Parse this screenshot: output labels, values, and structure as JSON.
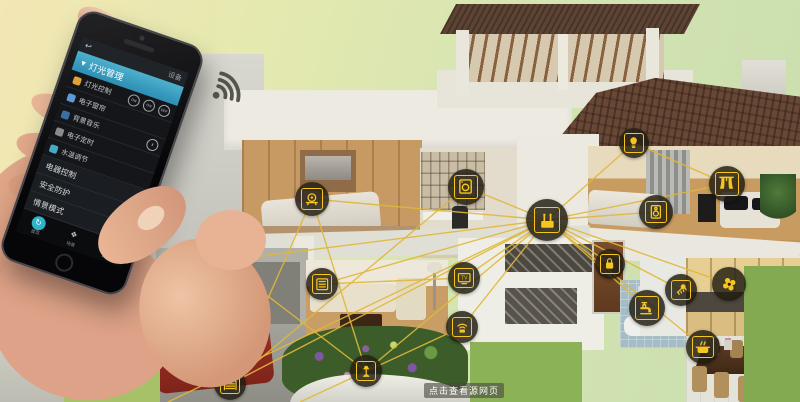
{
  "watermark": {
    "text": "点击查看源网页"
  },
  "phone_app": {
    "top_bar": {
      "back_icon": "↩",
      "right_label": "设备"
    },
    "group_header": {
      "expand_icon": "▾",
      "label": "灯光管理"
    },
    "device_rows": [
      {
        "icon": "bulb-icon",
        "label": "灯光控制",
        "toggles": [
          "ON",
          "ON",
          "OFF"
        ]
      },
      {
        "icon": "curtain-icon",
        "label": "电子窗帘",
        "toggles": []
      },
      {
        "icon": "music-icon",
        "label": "背景音乐",
        "toggles": [
          "Ⅱ"
        ]
      },
      {
        "icon": "timer-icon",
        "label": "电子定时",
        "toggles": []
      },
      {
        "icon": "water-icon",
        "label": "水温调节",
        "toggles": []
      }
    ],
    "section_rows": [
      "电器控制",
      "安全防护",
      "情景模式"
    ],
    "bottom_nav": [
      {
        "icon": "home-icon",
        "glyph": "↻",
        "label": "首页",
        "active": true
      },
      {
        "icon": "scene-icon",
        "glyph": "❖",
        "label": "场景",
        "active": false
      },
      {
        "icon": "more-icon",
        "glyph": "▦",
        "label": "更多",
        "active": false
      }
    ]
  },
  "smart_home": {
    "accent_yellow": "#f6c51f",
    "line_color": "#dfb83a",
    "wireless_icon": "wireless-signal-icon",
    "devices": [
      {
        "name": "hub-router",
        "x": 547,
        "y": 220,
        "r": 21,
        "hub": true
      },
      {
        "name": "cctv-camera",
        "x": 222,
        "y": 261,
        "r": 17
      },
      {
        "name": "dome-camera",
        "x": 312,
        "y": 199,
        "r": 17
      },
      {
        "name": "keypad-panel",
        "x": 322,
        "y": 284,
        "r": 16
      },
      {
        "name": "garden-light",
        "x": 366,
        "y": 371,
        "r": 16
      },
      {
        "name": "garage-door",
        "x": 230,
        "y": 384,
        "r": 16
      },
      {
        "name": "washer",
        "x": 466,
        "y": 187,
        "r": 18
      },
      {
        "name": "tv",
        "x": 464,
        "y": 278,
        "r": 16
      },
      {
        "name": "wifi-device",
        "x": 462,
        "y": 327,
        "r": 16
      },
      {
        "name": "door-lock",
        "x": 610,
        "y": 264,
        "r": 15
      },
      {
        "name": "light-bulb",
        "x": 634,
        "y": 143,
        "r": 15
      },
      {
        "name": "speaker",
        "x": 656,
        "y": 212,
        "r": 17
      },
      {
        "name": "curtains",
        "x": 727,
        "y": 184,
        "r": 18
      },
      {
        "name": "faucet",
        "x": 647,
        "y": 308,
        "r": 18
      },
      {
        "name": "shower",
        "x": 681,
        "y": 290,
        "r": 16
      },
      {
        "name": "fan",
        "x": 729,
        "y": 284,
        "r": 17,
        "fan": true
      },
      {
        "name": "cooker",
        "x": 703,
        "y": 347,
        "r": 17
      }
    ],
    "extra_links": [
      [
        222,
        261,
        230,
        384
      ],
      [
        312,
        199,
        366,
        371
      ],
      [
        222,
        261,
        366,
        371
      ],
      [
        466,
        187,
        230,
        384
      ],
      [
        464,
        278,
        322,
        284
      ],
      [
        462,
        327,
        300,
        402
      ],
      [
        634,
        143,
        727,
        184
      ],
      [
        547,
        220,
        168,
        402
      ],
      [
        312,
        199,
        230,
        384
      ]
    ]
  }
}
